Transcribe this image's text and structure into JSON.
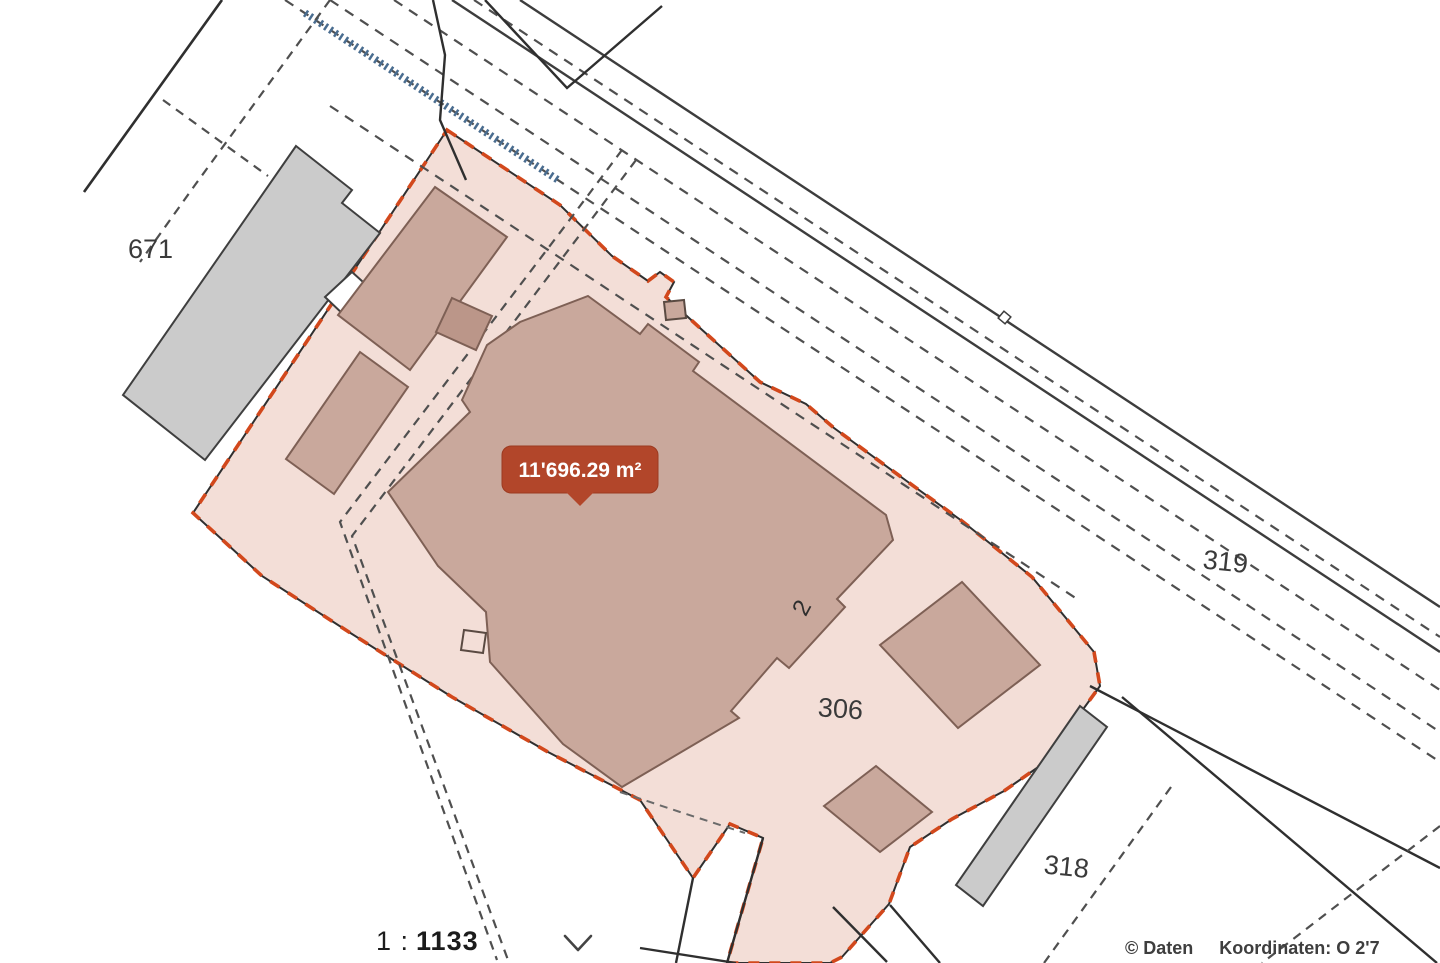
{
  "map": {
    "labels": {
      "p671": "671",
      "p319": "319",
      "p306": "306",
      "p318": "318",
      "house2": "2"
    },
    "area_tooltip": {
      "text": "11'696.29 m²",
      "bg_color": "#b2462a",
      "text_color": "#ffffff"
    },
    "highlight": {
      "parcel_fill": "#f3ded7",
      "border_dash_color": "#d2481c",
      "border_line_color": "#2f2f2f"
    },
    "building_fill": "#c9a89c",
    "building_stroke": "#7e6055",
    "connector_fill": "#bb9689",
    "gray_building_fill": "#cbcbcb",
    "railway_hatch_color": "#4a6d90",
    "line_color": "#3d3d3d"
  },
  "scale_control": {
    "prefix": "1 :",
    "value": "1133",
    "chevron_icon": "chevron-down-icon"
  },
  "attribution": {
    "copyright": "© Daten",
    "coordinates": "Koordinaten: O 2'7"
  }
}
